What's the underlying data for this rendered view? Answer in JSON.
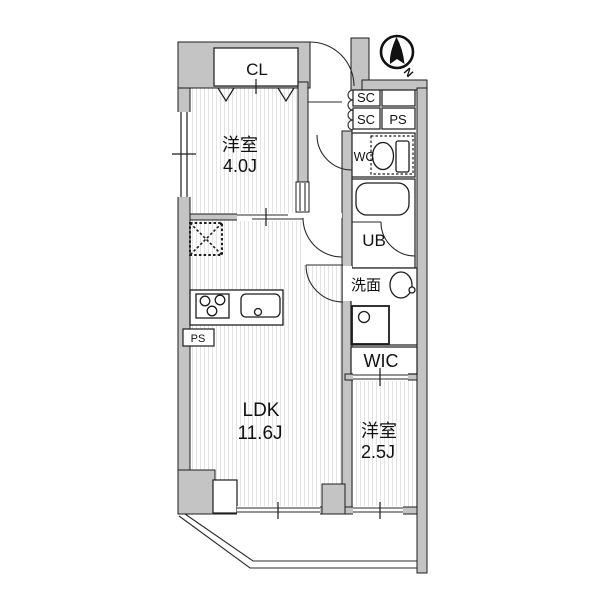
{
  "plan": {
    "compass": {
      "north": "N"
    },
    "labels": {
      "closet": "CL",
      "bedroom1_name": "洋室",
      "bedroom1_size": "4.0J",
      "shoe_closet_1": "SC",
      "shoe_closet_2": "SC",
      "pipe_space_top": "PS",
      "toilet": "WC",
      "unit_bath": "UB",
      "washroom": "洗面",
      "walk_in_closet": "WIC",
      "ldk_name": "LDK",
      "ldk_size": "11.6J",
      "bedroom2_name": "洋室",
      "bedroom2_size": "2.5J",
      "pipe_space_kitchen": "PS"
    },
    "colors": {
      "wall_fill": "#c4c4c4",
      "outline": "#1c1c1c",
      "hatch_line": "#e3e3e3",
      "background": "#ffffff",
      "compass_black": "#111111"
    }
  }
}
